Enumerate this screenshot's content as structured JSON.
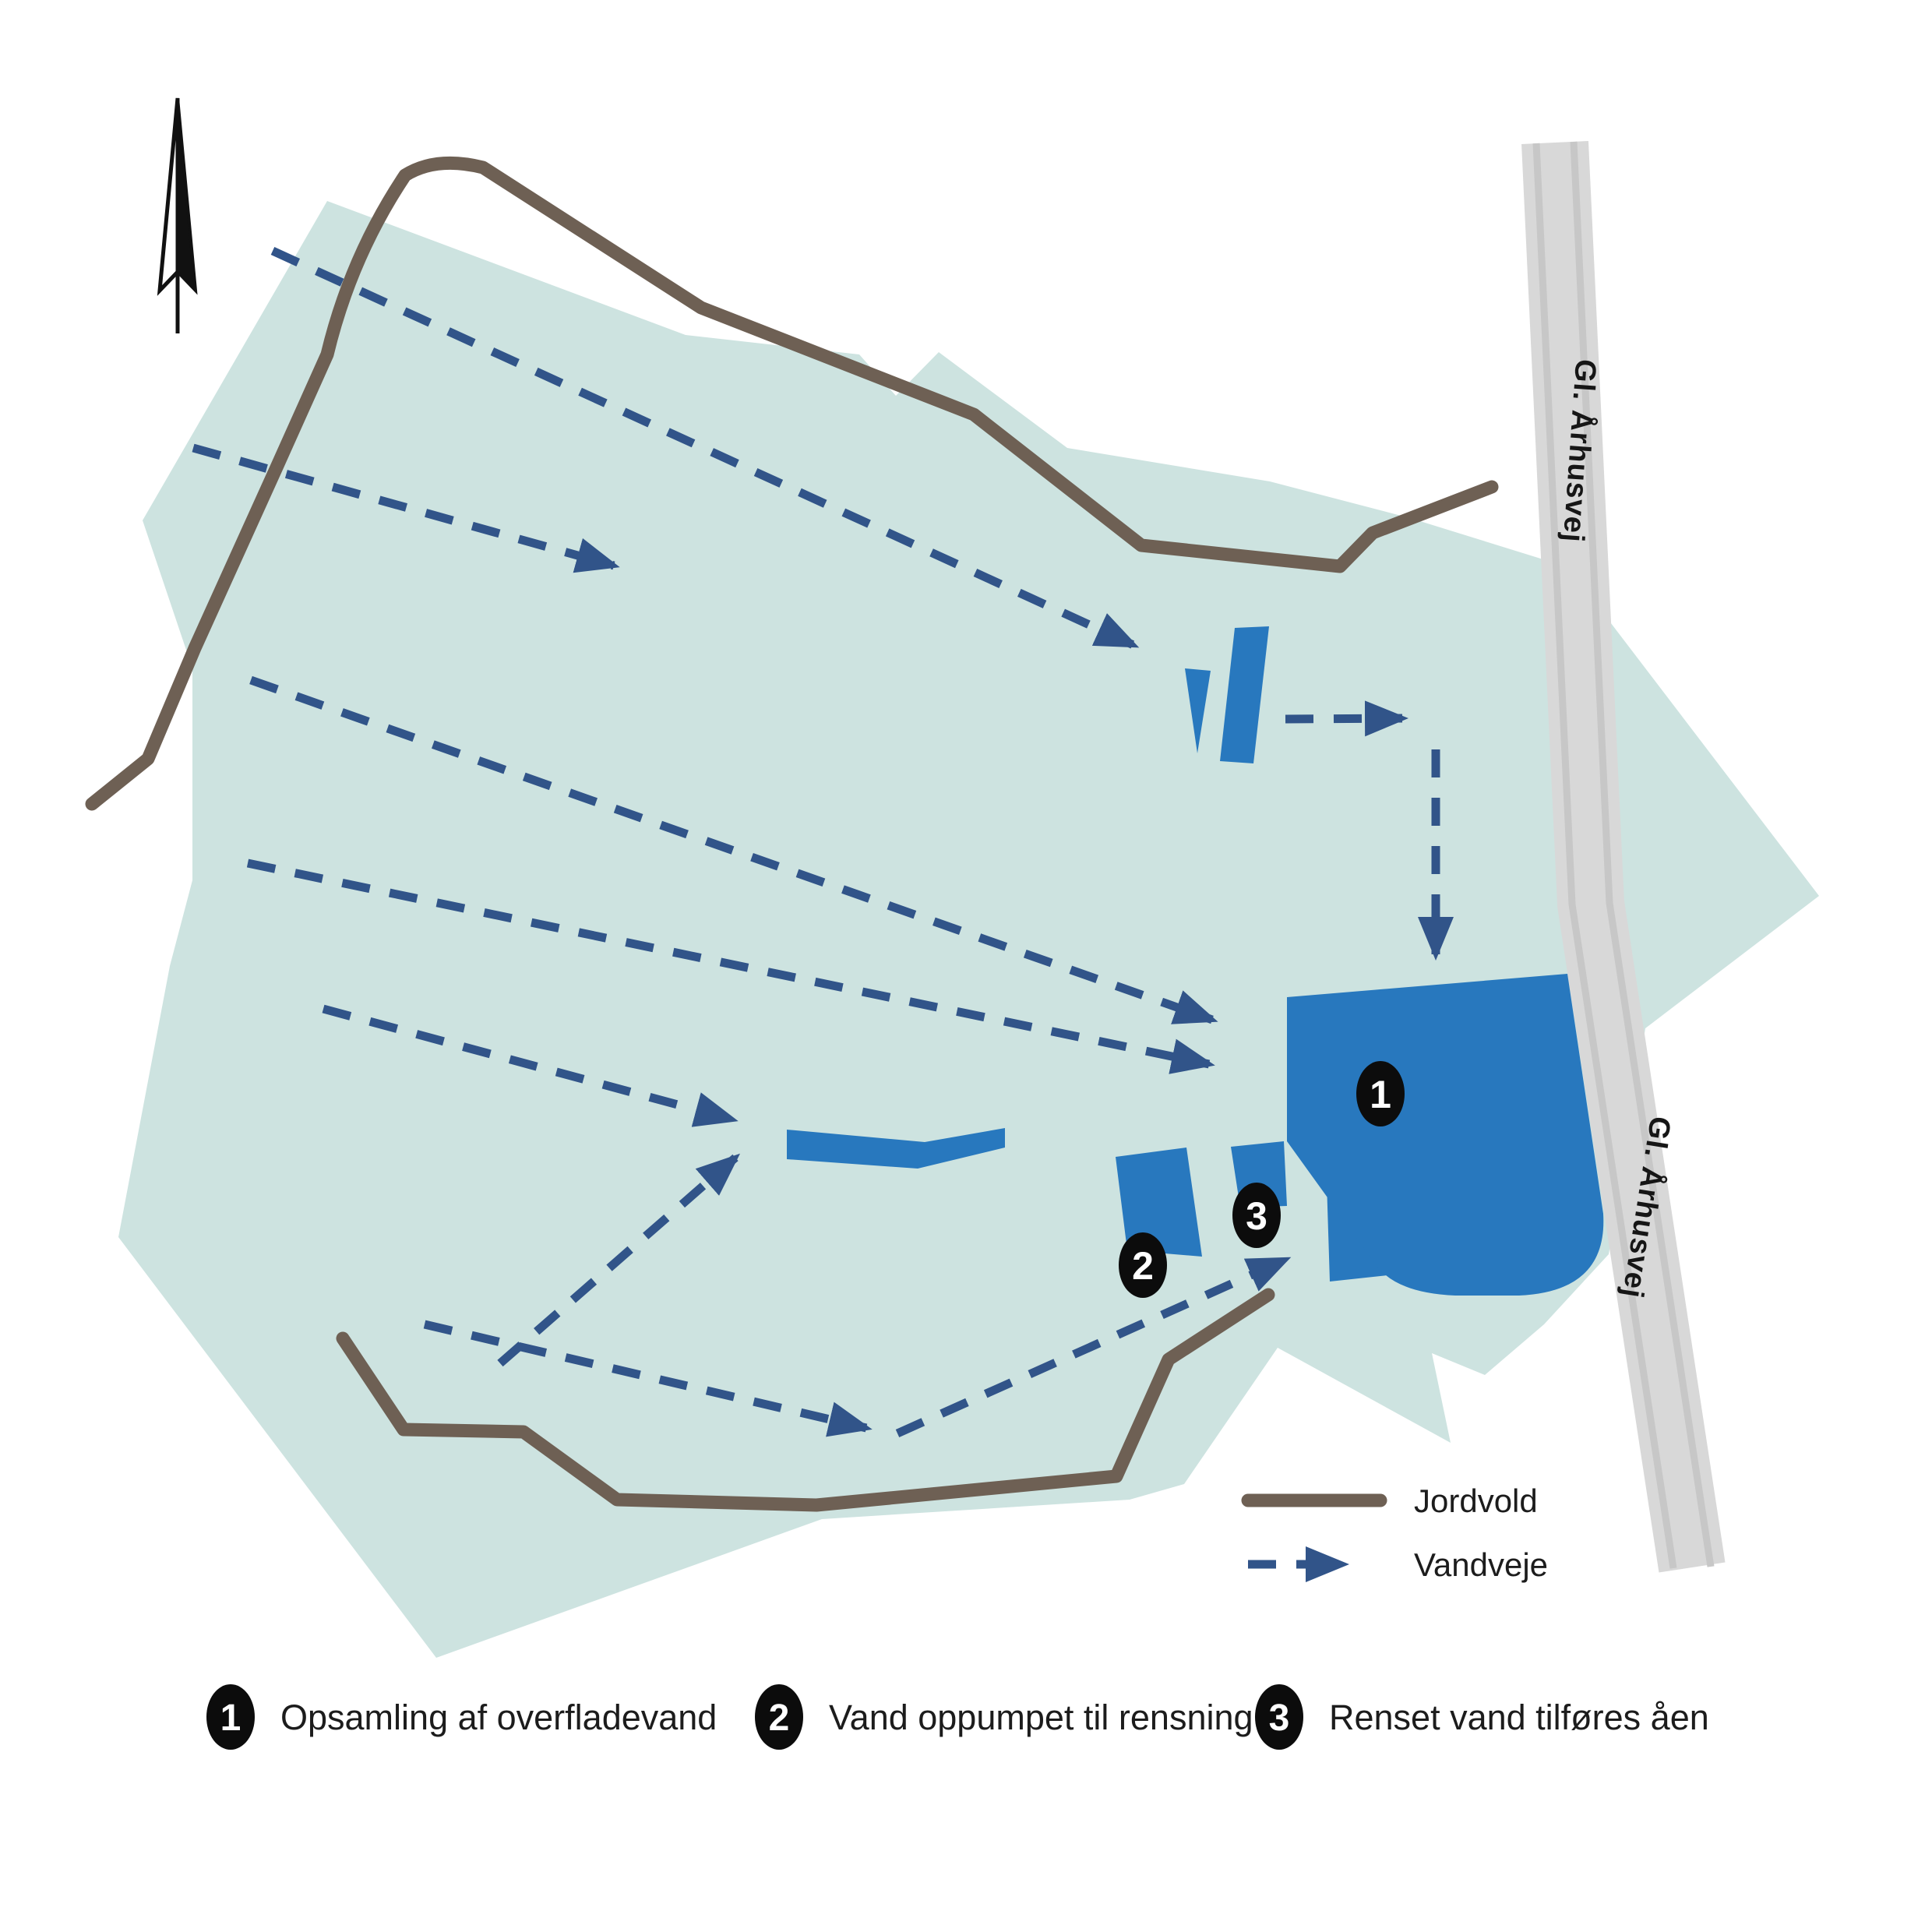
{
  "colors": {
    "site_area": "#cde3e0",
    "water_basin": "#2878be",
    "waterway_arrow": "#315489",
    "jordvold_line": "#6e6054",
    "road_fill": "#d8d8d8",
    "marker_bg": "#0c0c0c"
  },
  "road": {
    "label_top": "Gl. Århusvej",
    "label_bottom": "Gl. Århusvej"
  },
  "map_markers": [
    {
      "number": "1"
    },
    {
      "number": "2"
    },
    {
      "number": "3"
    }
  ],
  "legend": {
    "jordvold": "Jordvold",
    "vandveje": "Vandveje"
  },
  "key": {
    "items": [
      {
        "number": "1",
        "label": "Opsamling af overfladevand"
      },
      {
        "number": "2",
        "label": "Vand oppumpet til rensning"
      },
      {
        "number": "3",
        "label": "Renset vand tilføres åen"
      }
    ]
  }
}
